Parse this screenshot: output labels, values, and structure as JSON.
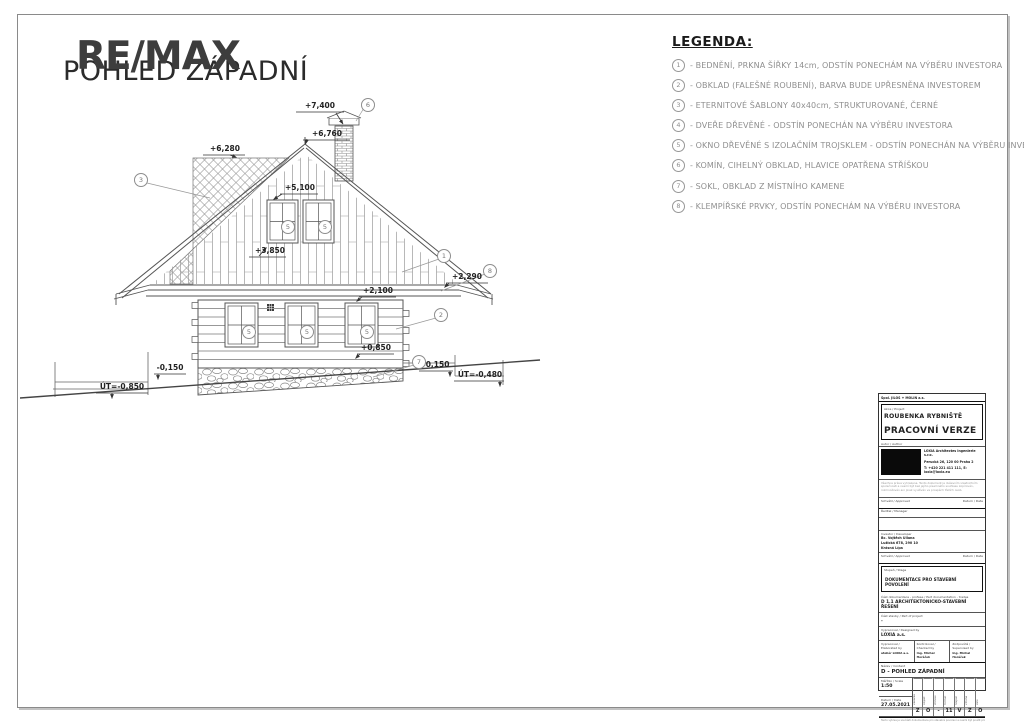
{
  "header": {
    "watermark": "RE/MAX",
    "title": "POHLED ZÁPADNÍ"
  },
  "legend": {
    "title": "LEGENDA:",
    "items": [
      {
        "num": "1",
        "text": "- BEDNĚNÍ, PRKNA ŠÍŘKY 14cm, ODSTÍN PONECHÁM NA VÝBĚRU INVESTORA"
      },
      {
        "num": "2",
        "text": "- OBKLAD (FALEŠNÉ ROUBENÍ), BARVA BUDE UPŘESNĚNA INVESTOREM"
      },
      {
        "num": "3",
        "text": "- ETERNITOVÉ ŠABLONY 40x40cm, STRUKTUROVANÉ, ČERNÉ"
      },
      {
        "num": "4",
        "text": "- DVEŘE DŘEVĚNÉ - ODSTÍN PONECHÁN NA VÝBĚRU INVESTORA"
      },
      {
        "num": "5",
        "text": "- OKNO DŘEVĚNÉ S IZOLAČNÍM TROJSKLEM - ODSTÍN PONECHÁN NA VÝBĚRU INVESTORA"
      },
      {
        "num": "6",
        "text": "- KOMÍN, CIHELNÝ OBKLAD, HLAVICE OPATŘENA STŘÍŠKOU"
      },
      {
        "num": "7",
        "text": "- SOKL, OBKLAD Z MÍSTNÍHO KAMENE"
      },
      {
        "num": "8",
        "text": "- KLEMPÍŘSKÉ PRVKY, ODSTÍN PONECHÁM NA VÝBĚRU INVESTORA"
      }
    ]
  },
  "drawing": {
    "dims": {
      "d7400": "+7,400",
      "d6760": "+6,760",
      "d6280": "+6,280",
      "d5100": "+5,100",
      "d3850": "+3,850",
      "d2100": "+2,100",
      "d2290": "+2,290",
      "d0850": "+0,850",
      "m0150a": "-0,150",
      "m0150b": "-0,150",
      "ut850": "ÚT=-0,850",
      "ut480": "ÚT=-0,480"
    },
    "markers": {
      "m1": "1",
      "m2": "2",
      "m3": "3",
      "m5": "5",
      "m6": "6",
      "m7": "7",
      "m8": "8"
    }
  },
  "titleblock": {
    "head": "Spol. JILOS + MOLIN a.s.",
    "project_label": "Akce / Project",
    "project_name": "ROUBENKA RYBNIŠTĚ",
    "version": "PRACOVNÍ VERZE",
    "author_label": "Autor / Author",
    "firm1": "LOXIA Architectes Ingenierie s.r.o.",
    "firm2": "Perucká 26, 120 00 Praha 2",
    "firm3": "T: +420 221 411 111, E: loxia@loxia.eu",
    "disclaimer": "Všechna práva vyhrazena. Tento dokument je duševním vlastnictvím společnosti a nesmí být bez jejího písemného souhlasu kopírován, rozmnožován ani jinak využíván ve prospěch třetích osob.",
    "approved_label": "Schválil / Approved",
    "date_label": "Datum / Date",
    "manager_label": "Ředitel / Manager",
    "investor_label": "Investor / Developer",
    "investor1": "Bc. Vojtěch Uliana",
    "investor2": "Lužická 678, 290 10",
    "investor3": "Krásná Lípa",
    "stage_label": "Stupeň / Stage",
    "stage": "DOKUMENTACE PRO STAVEBNÍ POVOLENÍ",
    "docpart_label": "Část dokumentace - profese / Part documentation - trades",
    "docpart": "D 1.1 ARCHITEKTONICKO-STAVEBNÍ ŘEŠENÍ",
    "buildpart_label": "Část stavby / Part of project",
    "buildpart": "-",
    "designed_label": "Vypracoval / Designed by",
    "designed": "LOXIA a.s.",
    "elab_label": "Vypracoval / Elaborated by",
    "elab": "ateliér LOXIA a.s.",
    "check_label": "Kontroloval / Checked by",
    "check": "Ing. Michal Horáček",
    "superv_label": "Zodpovídá / Supervised by",
    "superv": "Ing. Michal Horáček",
    "content_label": "Název / Content",
    "content": "D - POHLED ZÁPADNÍ",
    "scale_label": "Měřítko / Scale",
    "scale": "1:50",
    "date2_label": "Datum / Date",
    "date": "27.05.2021",
    "code_labels": [
      "Zakázka",
      "Objekt",
      "Profese",
      "Formát",
      "Stupeň",
      "Změna",
      "Paré"
    ],
    "code_cells": [
      "Z",
      "O",
      "-",
      "11",
      "V",
      "Z",
      "O"
    ],
    "footer": "Tento výkres je součástí dokumentace pro stavební povolení a nesmí být použit pro provádění stavby."
  }
}
